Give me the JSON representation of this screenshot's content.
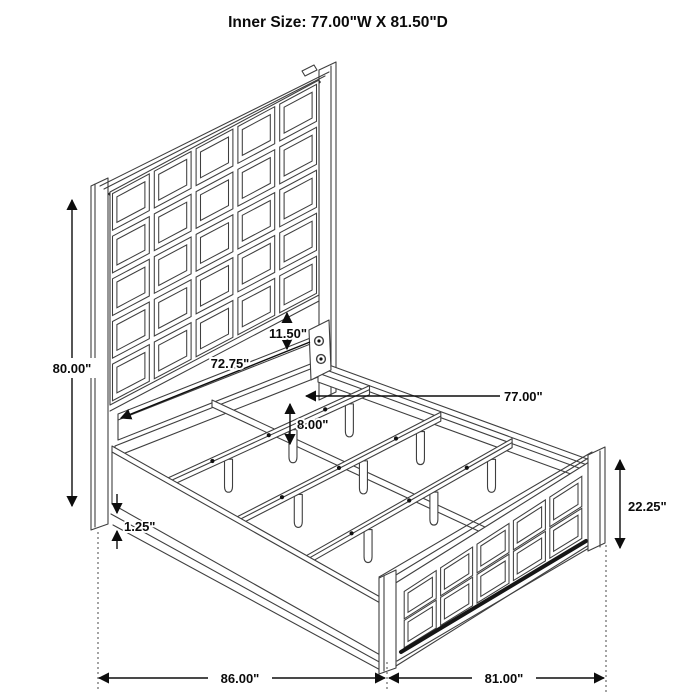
{
  "title": "Inner Size: 77.00\"W X 81.50\"D",
  "dimensions": {
    "overall_height": "80.00\"",
    "headboard_rail_width": "72.75\"",
    "headboard_to_rail_gap": "11.50\"",
    "inner_width": "77.00\"",
    "slat_leg_height": "8.00\"",
    "rail_bottom_edge": "1.25\"",
    "footboard_height": "22.25\"",
    "overall_depth": "86.00\"",
    "footboard_width": "81.00\""
  },
  "diagram": {
    "type": "isometric-line-drawing",
    "subject": "panel bed frame with slat support system",
    "headboard_grid": {
      "cols": 5,
      "rows": 5
    },
    "footboard_grid": {
      "cols": 5,
      "rows": 2
    },
    "slat_count": 3,
    "legs_per_slat": 3,
    "line_color": "#3f3f3f",
    "text_color": "#0a0a0a",
    "background_color": "#ffffff"
  }
}
